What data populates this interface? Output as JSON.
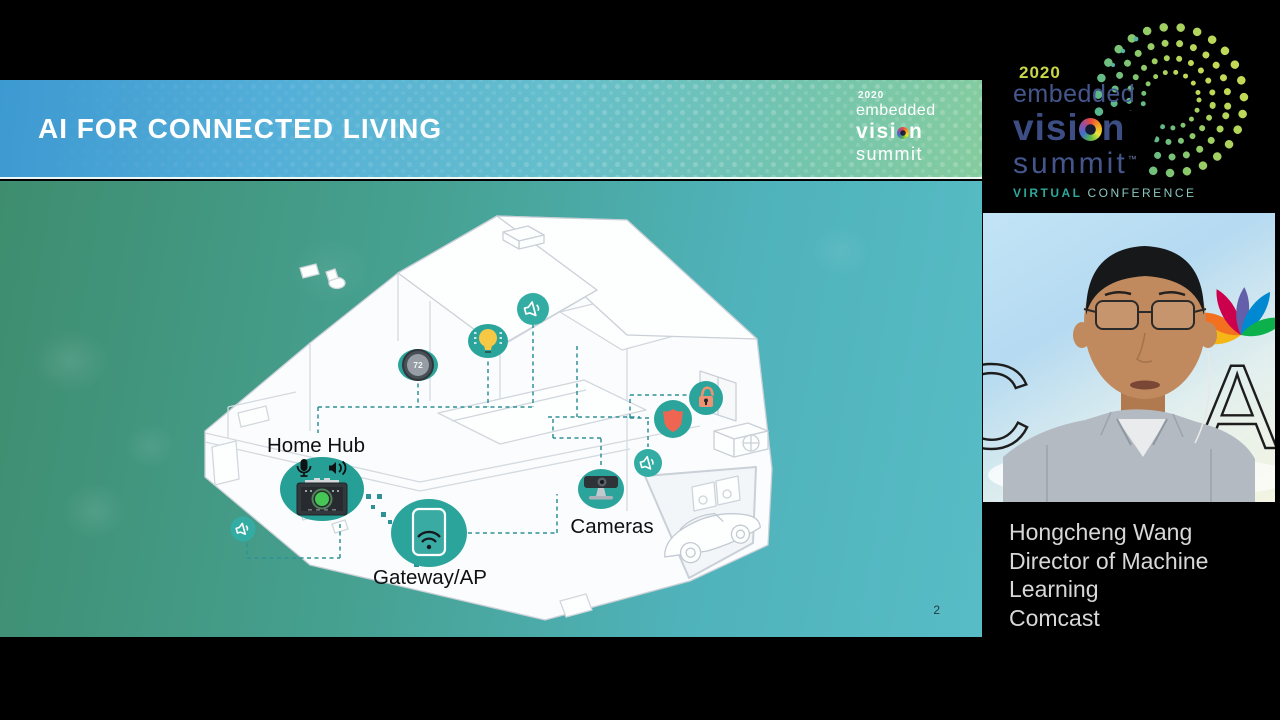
{
  "slide": {
    "title": "AI FOR CONNECTED LIVING",
    "page_number": "2",
    "titlebar_logo": {
      "year": "2020",
      "embedded": "embedded",
      "vision_pre": "visi",
      "vision_post": "n",
      "summit": "summit"
    },
    "diagram": {
      "home_hub_label": "Home Hub",
      "gateway_label": "Gateway/AP",
      "cameras_label": "Cameras",
      "thermostat_value": "72"
    }
  },
  "right_panel": {
    "logo": {
      "year": "2020",
      "embedded": "embedded",
      "vision_pre": "visi",
      "vision_post": "n",
      "summit": "summit",
      "tm": "™",
      "virtual": "VIRTUAL",
      "conference": "CONFERENCE"
    },
    "speaker": {
      "name": "Hongcheng Wang",
      "role": "Director of Machine Learning",
      "company": "Comcast"
    }
  },
  "colors": {
    "accent_teal": "#2ba59c",
    "slide_green": "#3e8d6f",
    "slide_teal": "#58bcc6",
    "titlebar_blue": "#3d99d1",
    "logo_navy": "#3c4e84",
    "logo_lime": "#c9d649",
    "virtual_teal": "#2fa79b",
    "shield_coral": "#ee6552",
    "lock_salmon": "#ef9273",
    "bulb_yellow": "#f6c844",
    "hub_green": "#45c655"
  }
}
